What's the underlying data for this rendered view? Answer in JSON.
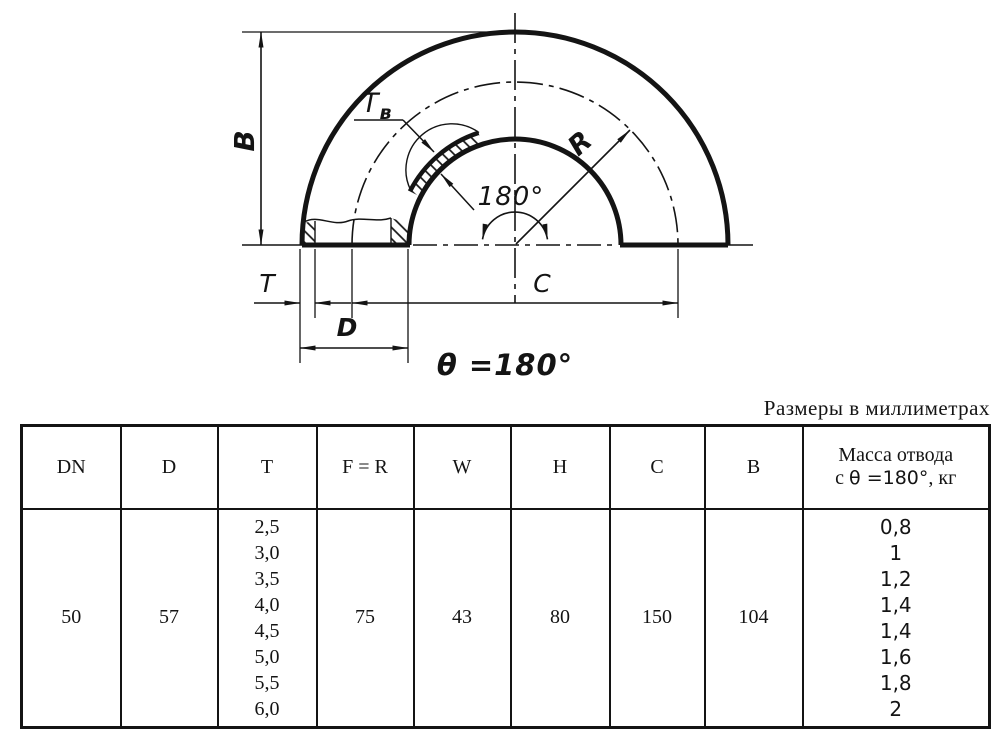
{
  "note": "Размеры в миллиметрах",
  "drawing": {
    "b": "B",
    "t": "T",
    "d": "D",
    "c": "C",
    "r": "R",
    "tv_main": "T",
    "tv_sub": "в",
    "angle": "180°",
    "theta": "θ =180°"
  },
  "table": {
    "headers": [
      "DN",
      "D",
      "T",
      "F = R",
      "W",
      "H",
      "C",
      "B"
    ],
    "mass_header": {
      "line1": "Масса отвода",
      "prefix": "с ",
      "theta": "θ =180°",
      "suffix": ", кг"
    },
    "row": {
      "dn": "50",
      "d": "57",
      "t_values": [
        "2,5",
        "3,0",
        "3,5",
        "4,0",
        "4,5",
        "5,0",
        "5,5",
        "6,0"
      ],
      "f_r": "75",
      "w": "43",
      "h": "80",
      "c": "150",
      "b": "104",
      "mass_values": [
        "0,8",
        "1",
        "1,2",
        "1,4",
        "1,4",
        "1,6",
        "1,8",
        "2"
      ]
    }
  }
}
